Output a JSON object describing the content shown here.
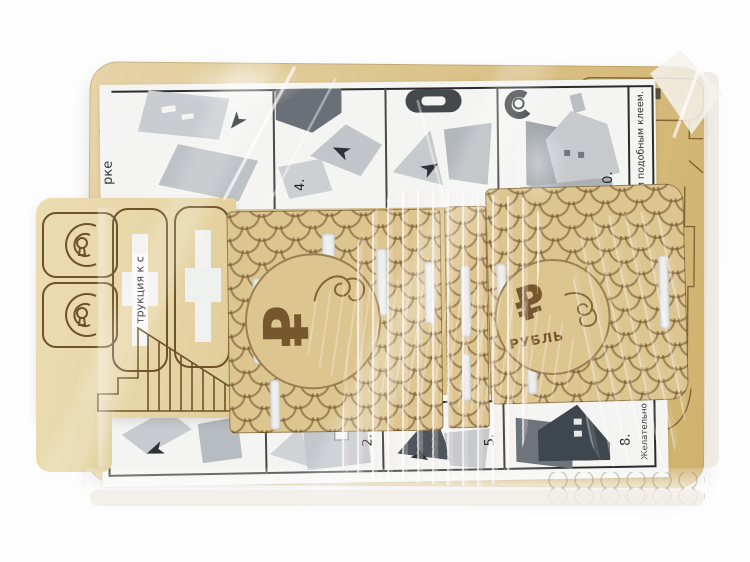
{
  "meta": {
    "description": "Wooden laser-cut 3D puzzle kit (ruble money-box house) sealed in transparent shrink wrap, printed assembly instruction sheet visible between the plywood panels",
    "background_color": "#ffffff"
  },
  "colors": {
    "wood": "#dcc48e",
    "wood_pale": "#e9d8ac",
    "wood_dark": "#cfb16c",
    "engraving": "#6e5228",
    "paper": "#f4f4f2",
    "ink": "#2b2b2b",
    "print_grey_light": "#c7cbcf",
    "print_grey_mid": "#9aa0a5",
    "print_grey_dark": "#5d646b",
    "plastic_glare": "#ffffff"
  },
  "instructions_top": {
    "edge_fragment": "рке",
    "step4_label": "4.",
    "step_last_label": "0.",
    "glue_note": "им подобным клеем.",
    "icons": {
      "capsule": "capsule-icon",
      "hook": "hook-icon",
      "arrow": "arrow-icon"
    }
  },
  "instructions_bottom": {
    "step2_label": "2.",
    "step5_label": "5.",
    "step8_label": "8.",
    "side_note": "Желательно"
  },
  "wood_parts": {
    "cutout_text_fragment": "трукция к с",
    "medallion_left": {
      "symbol": "₽"
    },
    "medallion_right": {
      "symbol": "₽",
      "caption": "РУБЛЬ"
    }
  }
}
